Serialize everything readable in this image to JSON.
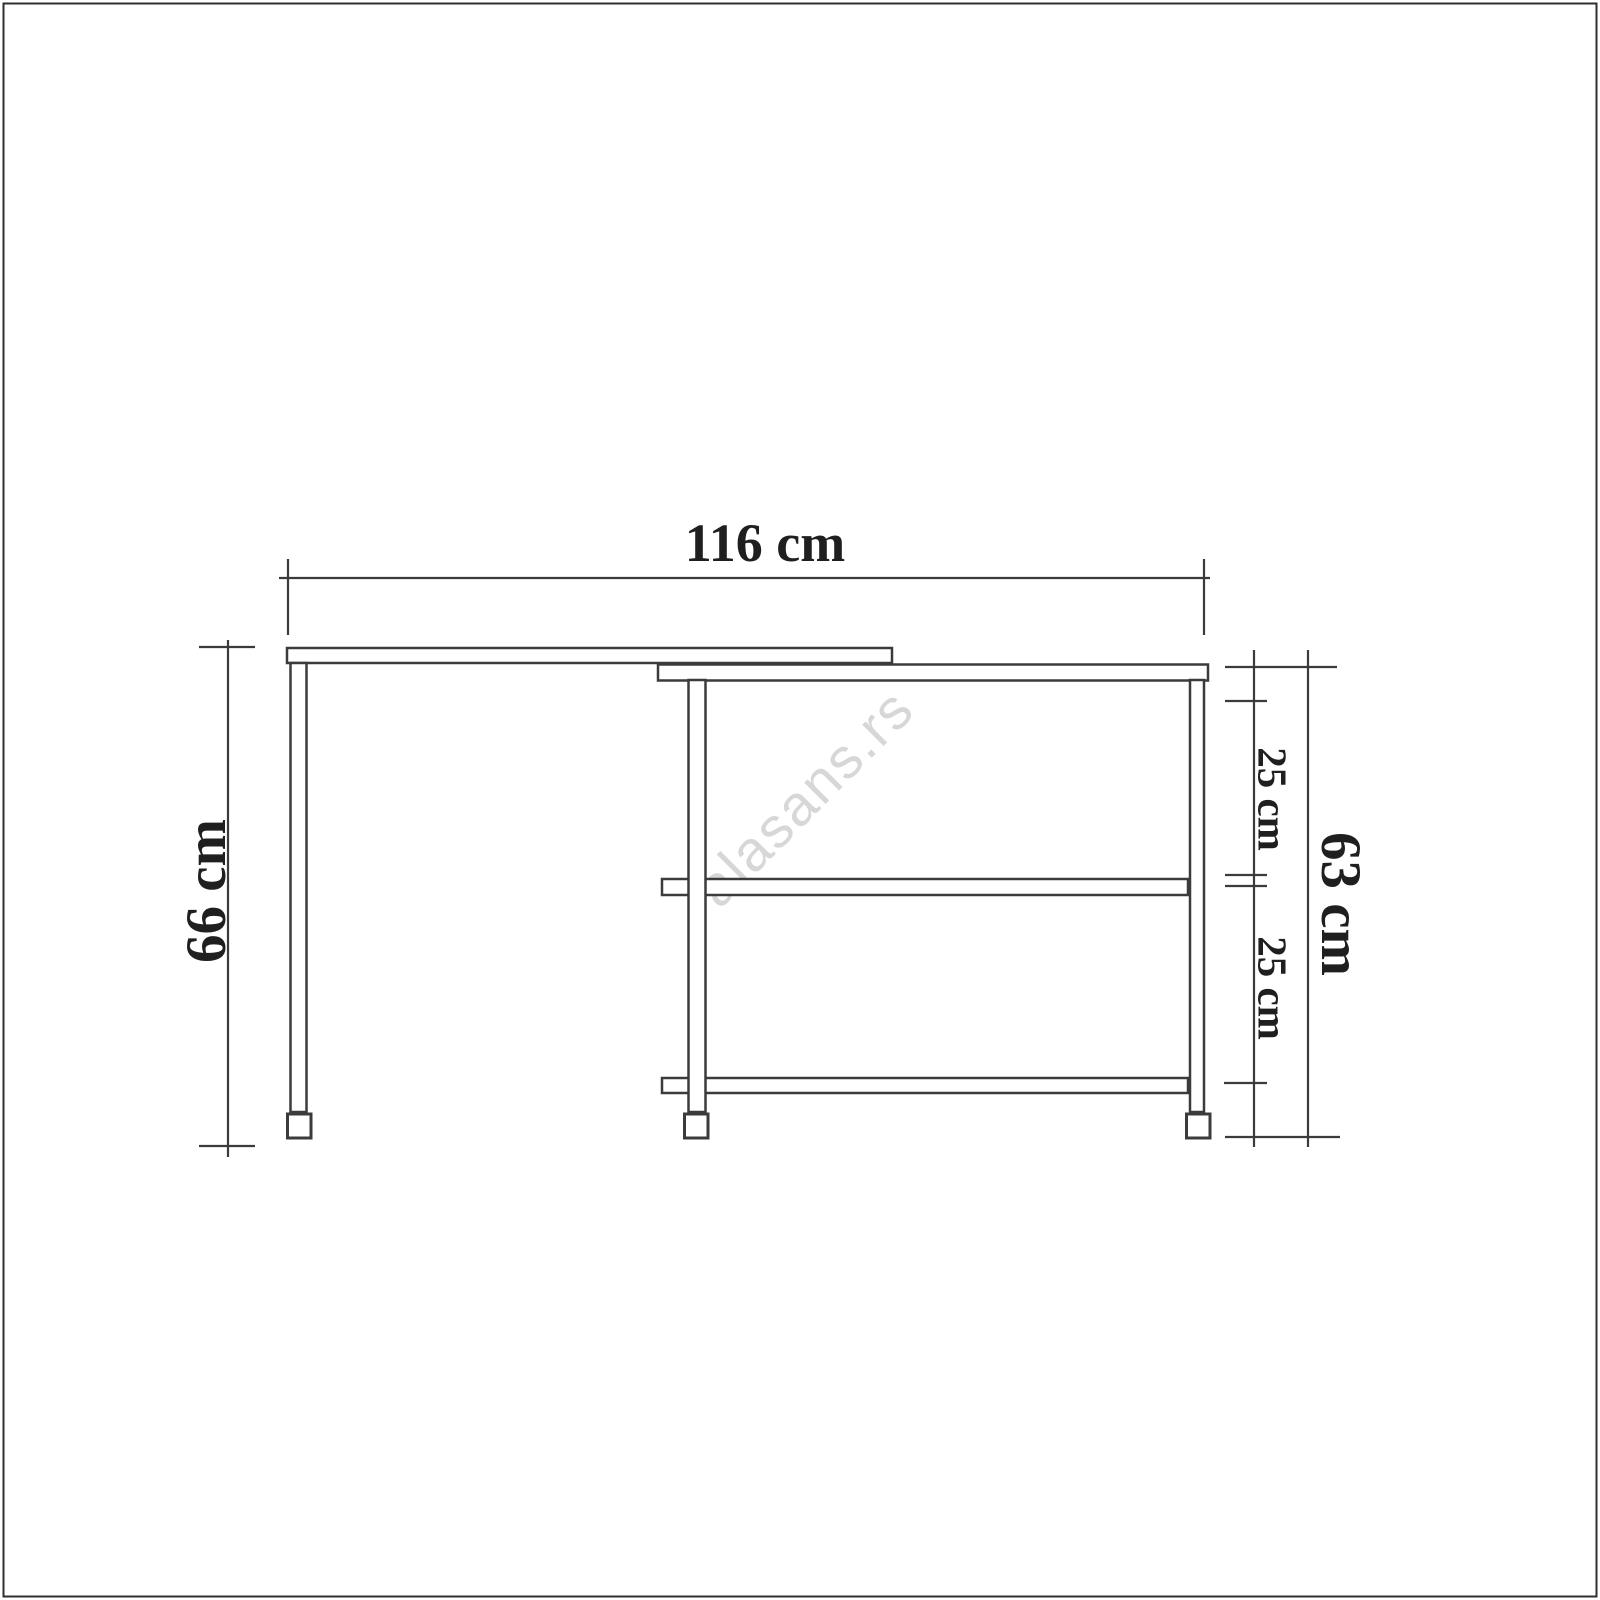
{
  "drawing": {
    "watermark": "alasans.rs",
    "labels": {
      "width": "116 cm",
      "height_left": "66 cm",
      "height_right": "63 cm",
      "gap_top": "25 cm",
      "gap_bottom": "25 cm"
    },
    "colors": {
      "line": "#3b3b3b",
      "text": "#1f1f1f",
      "watermark": "#d7d7d7",
      "border": "#2f2f2f",
      "background": "#ffffff"
    }
  }
}
